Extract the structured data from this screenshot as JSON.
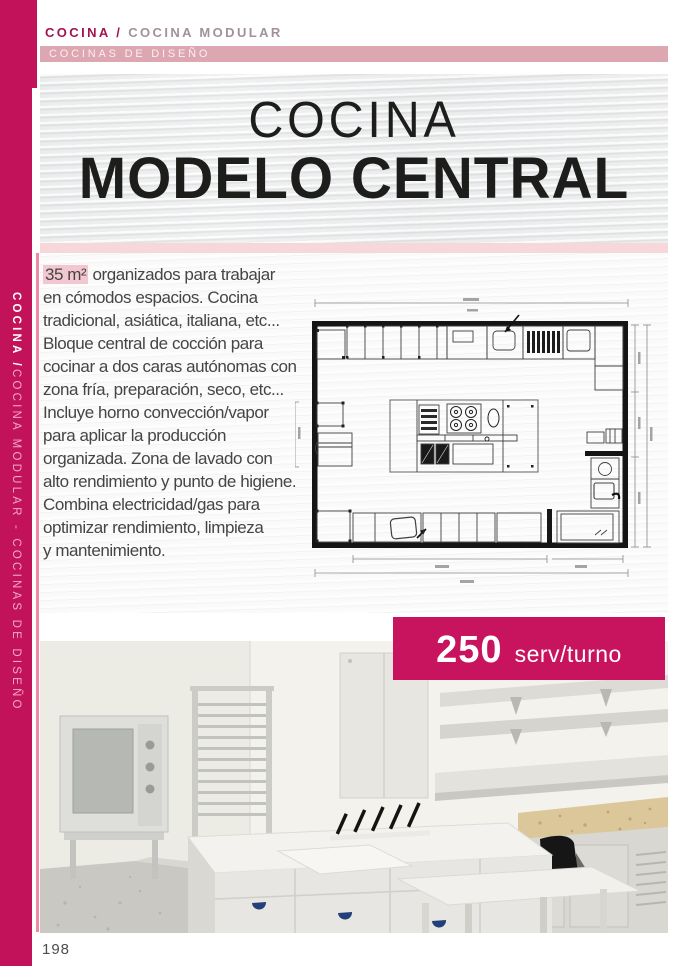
{
  "breadcrumb": {
    "section": "COCINA /",
    "subsection": " COCINA MODULAR"
  },
  "category_bar": {
    "label": "COCINAS DE DISEÑO"
  },
  "banner": {
    "title_line1": "COCINA",
    "title_line2": "MODELO CENTRAL"
  },
  "sidebar": {
    "vertical_text_bold": "COCINA / ",
    "vertical_text_rest": "COCINA MODULAR - COCINAS DE DISEÑO"
  },
  "description": {
    "line1_highlight": "35 m²",
    "line1_rest": " organizados para trabajar",
    "lines": [
      "en cómodos espacios. Cocina",
      "tradicional, asiática, italiana, etc...",
      "Bloque central de cocción para",
      "cocinar a dos caras autónomas con",
      "zona fría, preparación, seco, etc...",
      "Incluye horno convección/vapor",
      "para aplicar la producción",
      "organizada. Zona de lavado con",
      "alto rendimiento y punto de higiene.",
      "Combina electricidad/gas para",
      "optimizar rendimiento, limpieza",
      "y mantenimiento."
    ]
  },
  "badge": {
    "value": "250",
    "unit": "serv/turno"
  },
  "page": {
    "number": "198"
  },
  "figures": {
    "floor_plan": "kitchen-floor-plan-technical-drawing",
    "photo": "kitchen-3d-render-photo"
  },
  "colors": {
    "accent": "#c2125a",
    "badge_bg": "#c8135e",
    "category_bar_bg": "#dda7b2",
    "pink_strip": "#f8d7db",
    "highlight_bg": "#f3c7d1",
    "headline_text": "#1d1d1b",
    "body_text": "#454543"
  }
}
